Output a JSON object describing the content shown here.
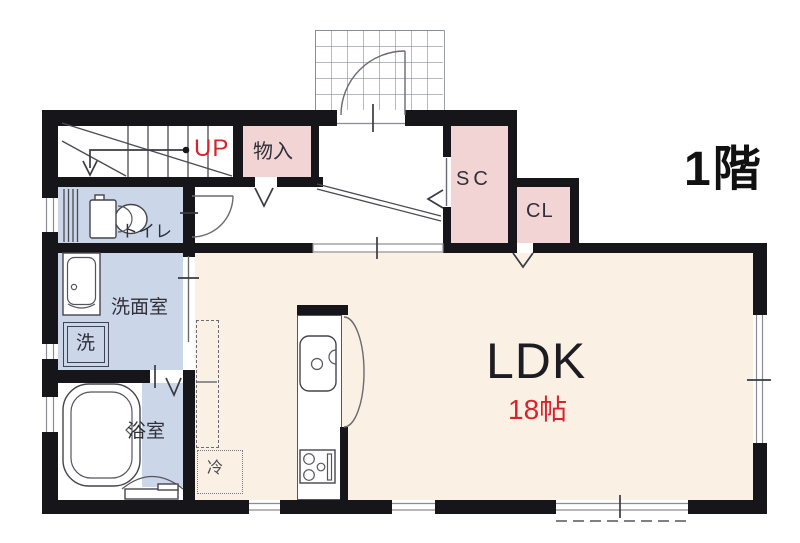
{
  "title": {
    "floor": "1階"
  },
  "colors": {
    "wall": "#16161a",
    "pink": "#f3d4d4",
    "blue": "#cbd6e9",
    "cream": "#faf0e3",
    "red": "#d8232e",
    "text": "#30303a"
  },
  "stairs": {
    "direction_label": "UP"
  },
  "rooms": {
    "storage": "物入",
    "shoe_closet": "SC",
    "closet": "CL",
    "toilet": "トイレ",
    "washroom": "洗面室",
    "laundry": "洗",
    "bathroom": "浴室",
    "ldk_name": "LDK",
    "ldk_size": "18帖",
    "refrigerator": "冷"
  }
}
